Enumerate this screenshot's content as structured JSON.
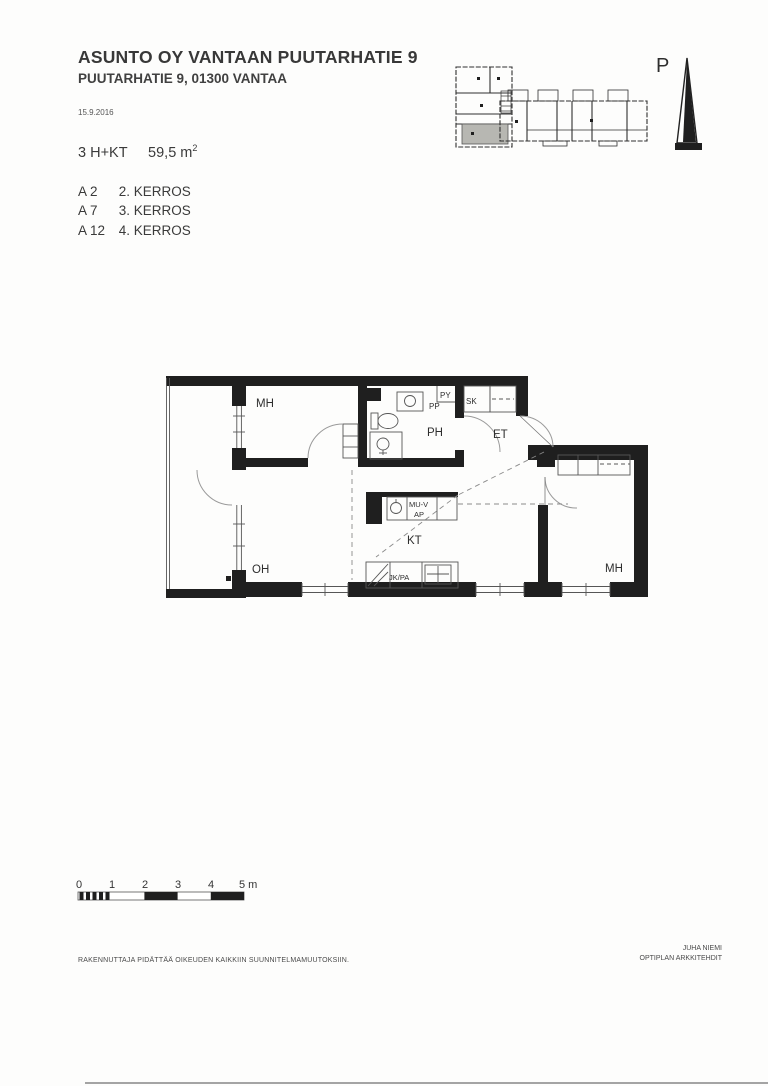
{
  "document": {
    "title": "ASUNTO OY VANTAAN PUUTARHATIE 9",
    "address": "PUUTARHATIE 9, 01300 VANTAA",
    "date": "15.9.2016",
    "apartment_type": "3 H+KT",
    "apartment_area": "59,5 m",
    "apartment_area_exp": "2",
    "units": [
      {
        "id": "A 2",
        "floor": "2. KERROS"
      },
      {
        "id": "A 7",
        "floor": "3. KERROS"
      },
      {
        "id": "A 12",
        "floor": "4. KERROS"
      }
    ],
    "footer": {
      "disclaimer": "RAKENNUTTAJA PIDÄTTÄÄ OIKEUDEN KAIKKIIN SUUNNITELMAMUUTOKSIIN.",
      "architect_name": "JUHA NIEMI",
      "architect_firm": "OPTIPLAN ARKKITEHDIT"
    }
  },
  "key_plan": {
    "north_label": "P"
  },
  "floor_plan": {
    "room_labels": {
      "bedroom_top_left": "MH",
      "bathroom": "PH",
      "entry_hall": "ET",
      "living_room": "OH",
      "kitchen": "KT",
      "bedroom_right": "MH"
    },
    "fixture_labels": {
      "cleaning_closet": "SK",
      "laundry": "PY",
      "washing_machine": "PP",
      "microwave_oven": "MU-V",
      "dishwasher": "AP",
      "fridge_freezer": "JK/PA"
    }
  },
  "scale_bar": {
    "ticks": [
      "0",
      "1",
      "2",
      "3",
      "4",
      "5 m"
    ]
  },
  "colors": {
    "ink": "#2b2b2b",
    "wall": "#1f1f1f",
    "highlight_unit": "#b7b7b2"
  }
}
